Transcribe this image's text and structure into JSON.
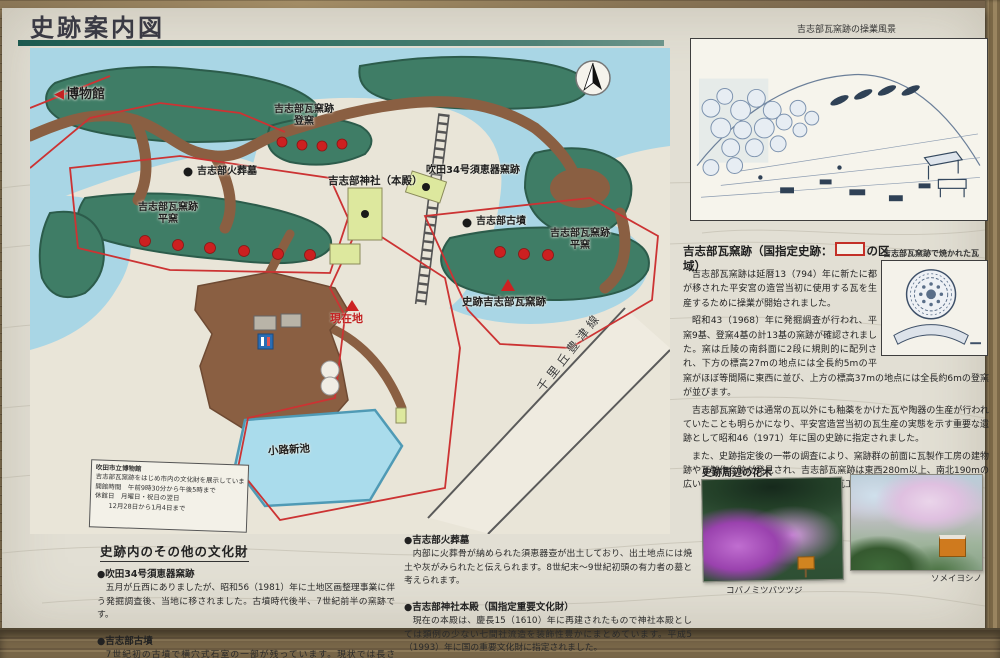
{
  "sign": {
    "title": "史跡案内図"
  },
  "map": {
    "labels": {
      "museum": "博物館",
      "noborigama_line1": "吉志部瓦窯跡",
      "noborigama_line2": "登窯",
      "kasoubo": "吉志部火葬墓",
      "shrine": "吉志部神社（本殿）",
      "sueki_kiln": "吹田34号須恵器窯跡",
      "kofun": "吉志部古墳",
      "hiragama_west_line1": "吉志部瓦窯跡",
      "hiragama_west_line2": "平窯",
      "hiragama_east_line1": "吉志部瓦窯跡",
      "hiragama_east_line2": "平窯",
      "historic_site": "史跡吉志部瓦窯跡",
      "current_location": "現在地",
      "pond": "小路新池",
      "road": "千里丘豊津線"
    },
    "museum_info_box": {
      "line1": "吹田市立博物館",
      "line2": "吉志部瓦窯跡をはじめ市内の文化財を展示しています。",
      "line3": "開館時間　午前9時30分から午後5時まで",
      "line4": "休館日　月曜日・祝日の翌日",
      "line5": "12月28日から1月4日まで"
    },
    "colors": {
      "water": "#a9d6e5",
      "forest": "#3f7d66",
      "path": "#8a5f42",
      "boundary": "#cc3333",
      "kiln_dot": "#cc2020",
      "site_dot": "#1a1a1a"
    }
  },
  "sketch": {
    "caption": "吉志部瓦窯跡の操業風景"
  },
  "article": {
    "heading_pre": "吉志部瓦窯跡（国指定史跡：",
    "heading_post": "の区域）",
    "paragraphs": [
      "吉志部瓦窯跡は延暦13（794）年に新たに都が移された平安宮の造営当初に使用する瓦を生産するために操業が開始されました。",
      "昭和43（1968）年に発掘調査が行われ、平窯9基、登窯4基の計13基の窯跡が確認されました。窯は丘陵の南斜面に2段に規則的に配列され、下方の標高27mの地点には全長約5mの平窯がほぼ等間隔に東西に並び、上方の標高37mの地点には全長約6mの登窯が並びます。",
      "吉志部瓦窯跡では通常の瓦以外にも釉薬をかけた瓦や陶器の生産が行われていたことも明らかになり、平安宮造営当初の瓦生産の実態を示す重要な遺跡として昭和46（1971）年に国の史跡に指定されました。",
      "また、史跡指定後の一帯の調査により、窯跡群の前面に瓦製作工房の建物跡や瓦製作台跡が発見され、吉志部瓦窯跡は東西280m以上、南北190mの広い範囲に展開する非常に大規模な造瓦工房であることがわかりました。"
    ]
  },
  "tile": {
    "caption": "吉志部瓦窯跡で焼かれた瓦"
  },
  "flora": {
    "heading": "史跡周辺の花木",
    "photo1_caption": "コバノミツバツツジ",
    "photo2_caption": "ソメイヨシノ"
  },
  "bottom": {
    "heading": "史跡内のその他の文化財",
    "items": [
      {
        "title": "●吹田34号須恵器窯跡",
        "body": "五月が丘西にありましたが、昭和56（1981）年に土地区画整理事業に伴う発掘調査後、当地に移されました。古墳時代後半、7世紀前半の窯跡です。"
      },
      {
        "title": "●吉志部古墳",
        "body": "7世紀初の古墳で横穴式石室の一部が残っています。現状では長さ3.3m、幅1.1m、高さ0.6mが残っています。"
      },
      {
        "title": "●吉志部火葬墓",
        "body": "内部に火葬骨が納められた須恵器壺が出土しており、出土地点には焼土や灰がみられたと伝えられます。8世紀末～9世紀初頭の有力者の墓と考えられます。"
      },
      {
        "title": "●吉志部神社本殿（国指定重要文化財）",
        "body": "現在の本殿は、慶長15（1610）年に再建されたもので神社本殿としては類例の少ない七間社流造を装飾性豊かにまとめています。平成5（1993）年に国の重要文化財に指定されました。"
      }
    ]
  }
}
